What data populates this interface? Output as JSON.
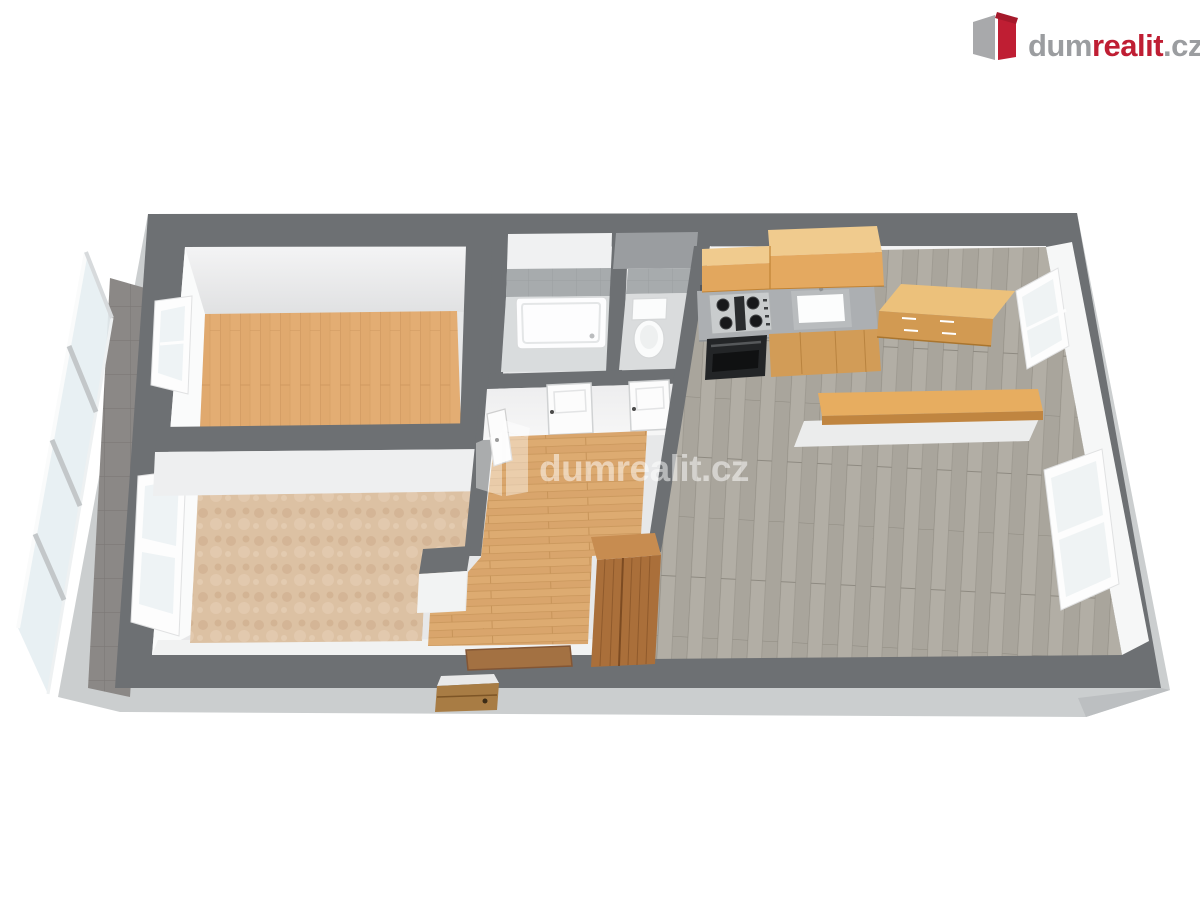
{
  "meta": {
    "description": "3D rendered floor plan of an apartment, viewed from above in perspective",
    "canvas": {
      "width": 1200,
      "height": 900
    }
  },
  "branding": {
    "logo": {
      "dum": "dum",
      "realit": "realit",
      "cz": ".cz",
      "full_text": "dumrealit.cz",
      "icon": "dumrealit-box-icon",
      "color_red": "#bf1e33",
      "color_gray": "#9b9da0"
    },
    "watermark": {
      "text": "dumrealit.cz",
      "icon": "dumrealit-box-icon",
      "color": "#ffffff",
      "opacity": 0.5
    }
  },
  "palette": {
    "wall_top_gray": "#6d7073",
    "slab_gray": "#cbcecf",
    "interior_wall_white": "#f5f5f6",
    "bedroom1_wood": "#e3ad73",
    "bedroom2_carpet": "#dcc1a3",
    "hall_wood": "#ddab71",
    "living_wood_gray": "#a9a59c",
    "balcony_tile": "#8b8886",
    "bathroom_tile": "#a7abad",
    "kitchen_cabinet_wood": "#e2a75e",
    "wardrobe_wood": "#aa6f3a",
    "counter_gray": "#acafb2",
    "glass_blue": "#e6eef2"
  },
  "scene": {
    "type": "floor-plan-3d",
    "rooms": [
      {
        "name": "bedroom-1",
        "floor": "light wood planks"
      },
      {
        "name": "bedroom-2",
        "floor": "beige carpet"
      },
      {
        "name": "bathroom",
        "floor": "tile",
        "fixtures": [
          "bathtub"
        ]
      },
      {
        "name": "wc",
        "fixtures": [
          "toilet"
        ]
      },
      {
        "name": "hallway",
        "floor": "wood planks"
      },
      {
        "name": "living-room-kitchen",
        "floor": "gray wood planks"
      },
      {
        "name": "balcony",
        "floor": "dark tile",
        "features": [
          "glass-railing"
        ]
      }
    ],
    "furniture": [
      "bathtub",
      "toilet",
      "kitchen-counter",
      "gas-hob",
      "oven",
      "sink",
      "upper-cabinets",
      "sideboard",
      "breakfast-bar",
      "wardrobe",
      "doormat",
      "entrance-door",
      "interior-doors",
      "windows"
    ]
  }
}
